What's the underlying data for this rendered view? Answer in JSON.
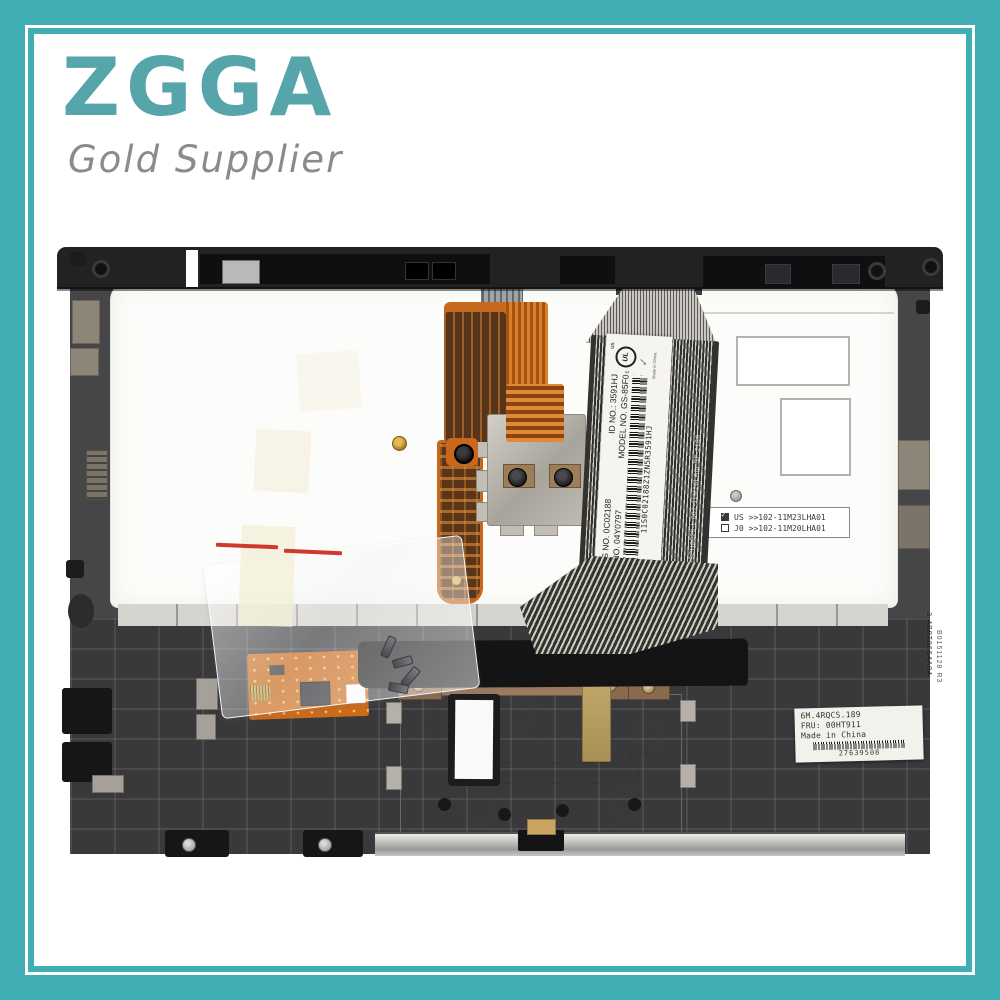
{
  "colors": {
    "frame_teal": "#40aeb5",
    "logo_teal": "#55a5ab",
    "tagline_gray": "#8a8b8d",
    "flex_orange": "#c9671c"
  },
  "brand": {
    "name": "ZGGA",
    "tagline": "Gold Supplier"
  },
  "photo": {
    "flex_label": {
      "parts_no": "PARTS NO. 0C02188",
      "id_no": "ID NO.: 3591HJ",
      "fru_no": "FRU    NO. 04Y0797",
      "model_no": "MODEL NO. GS-85F0",
      "barcode_text": "11S0C02188Z1ZN5R3591HJ",
      "ul_text": "UL",
      "ul_c": "c",
      "ul_us": "us",
      "ul_check": "✓",
      "made_in": "Made in China"
    },
    "cable_print": "i 30i 2R   JIT 79CH0020-L  002-11M26LA0i   SF-2186",
    "compat_label": {
      "rows": [
        {
          "checked": true,
          "code": "US",
          "value": ">>102-11M23LHA01"
        },
        {
          "checked": false,
          "code": "J0",
          "value": ">>102-11M20LHA01"
        }
      ]
    },
    "fru_label": {
      "line1": "6M.4RQCS.189",
      "line2": "FRU: 00HT911",
      "line3": "Made in  China",
      "barcode_text": "27639508"
    },
    "mold_text": "#2-1",
    "emboss_right": "3-4B0T8664A04",
    "emboss_right2": "B0151128 R3"
  }
}
